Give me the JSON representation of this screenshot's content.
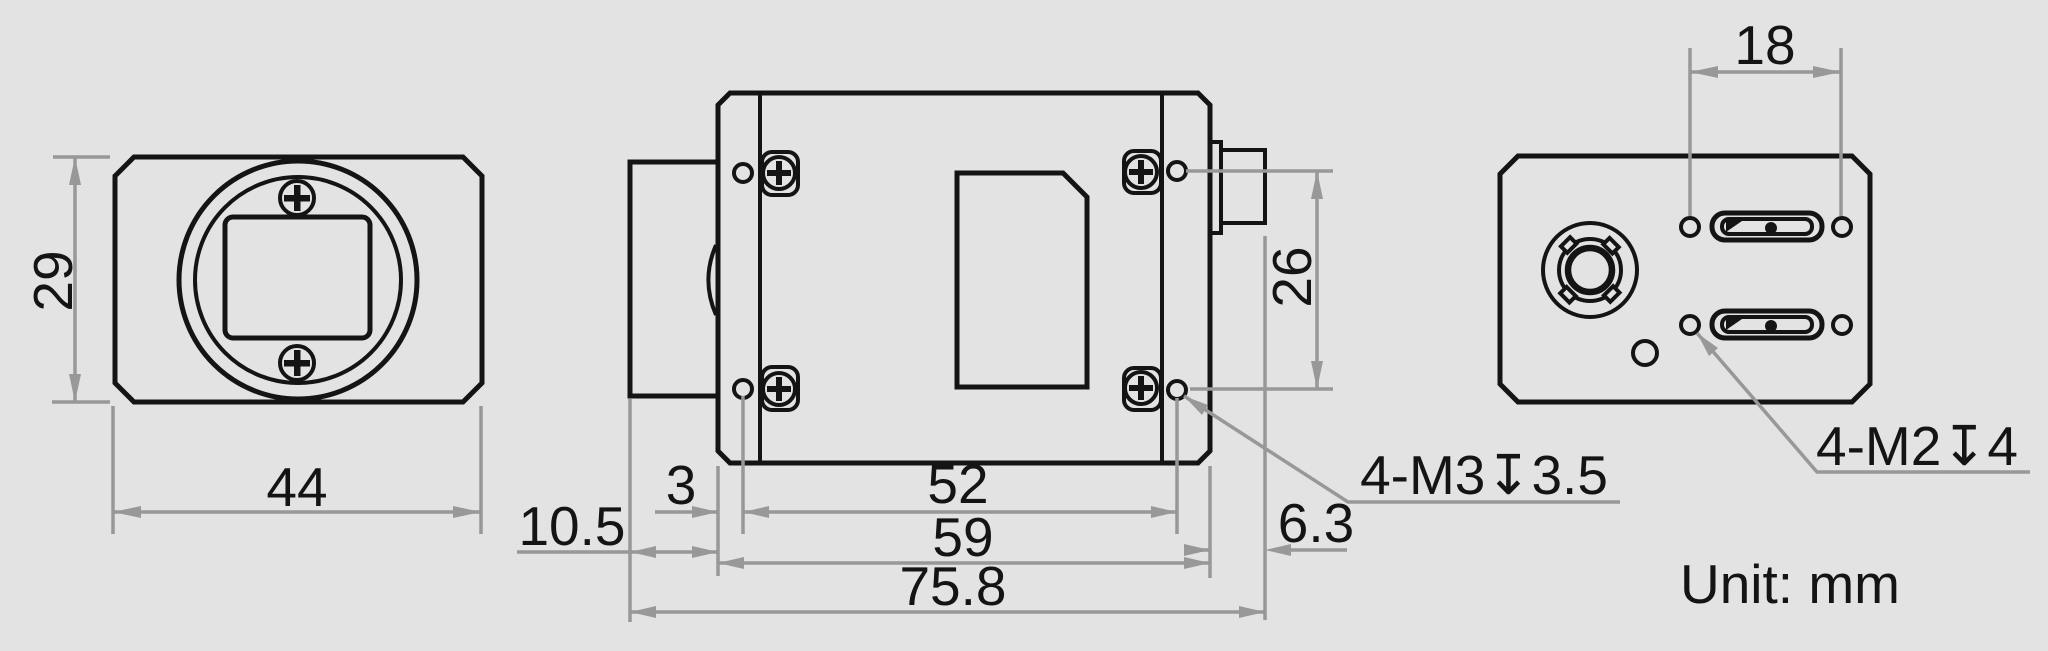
{
  "unit_note": "Unit: mm",
  "front_view": {
    "height": "29",
    "width": "44"
  },
  "top_view": {
    "lens_offset": "10.5",
    "hole_inset": "3",
    "hole_spacing_h": "52",
    "body_length": "59",
    "overall_length": "75.8",
    "hole_spacing_v": "26",
    "connector_offset": "6.3",
    "thread_note": "4-M3↧3.5"
  },
  "back_view": {
    "hole_spacing": "18",
    "thread_note": "4-M2↧4"
  }
}
